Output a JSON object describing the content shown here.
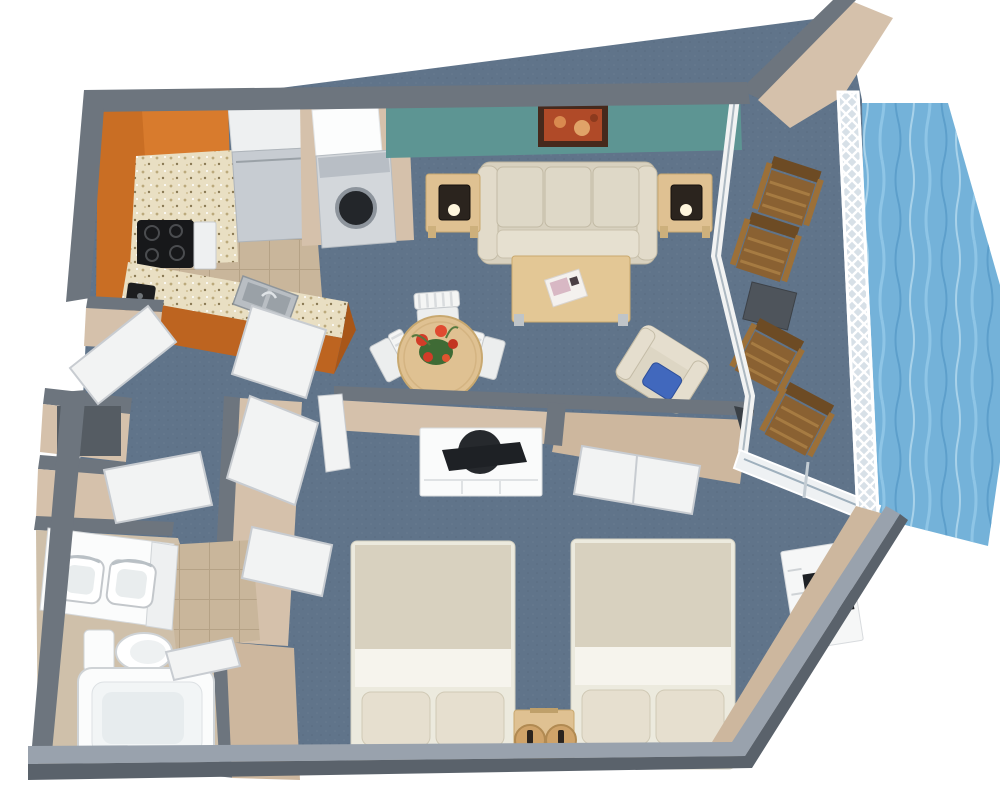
{
  "scene": {
    "type": "3d-floor-plan-rendering",
    "description": "Top-down 3D floor plan of a one-bedroom waterfront suite with kitchen, living-dining room, two-bed bedroom, bathroom and furnished balcony overlooking water"
  },
  "colors": {
    "background": "#ffffff",
    "wall_gray": "#6d757e",
    "wall_gray_dark": "#5a626b",
    "wall_top_light": "#99a2ad",
    "wall_tan": "#d5c1ab",
    "wall_tan_dark": "#c2ab92",
    "accent_teal": "#5d9593",
    "carpet": "#60748a",
    "tile": "#c9b69b",
    "bath_floor": "#cfc0aa",
    "cabinet_orange": "#d87b2d",
    "cabinet_orange_dark": "#bd6420",
    "counter_granite": "#e9dfc3",
    "wood_light": "#dfc192",
    "wood_brown": "#8a6132",
    "fabric_beige": "#d8d1bf",
    "linen_white": "#f6f4ed",
    "furniture_white": "#f3f4f4",
    "appliance_gray": "#c7ccd2",
    "water": "#74b2d9",
    "tv_black": "#1e2125",
    "lamp_black": "#2b241e",
    "pillow_blue": "#4168bd",
    "art_rust": "#b04a28",
    "frame_brown": "#46291c",
    "flower_red": "#d23c28",
    "leaf_green": "#3f6b35",
    "magazine_pink": "#d8b8c4",
    "door_white": "#f2f3f3",
    "niche_dark": "#555c63"
  },
  "rooms": [
    {
      "name": "Kitchen",
      "furniture": [
        "L-shaped orange cabinets",
        "granite countertop peninsula",
        "black cooktop stove",
        "refrigerator",
        "stacked washer-dryer",
        "double-basin sink",
        "coffee maker"
      ]
    },
    {
      "name": "Living Room",
      "furniture": [
        "teal accent wall",
        "framed wall art",
        "three-seat beige sofa",
        "left end table with lamp",
        "right end table with lamp",
        "wood coffee table",
        "magazine"
      ]
    },
    {
      "name": "Dining Area",
      "furniture": [
        "round wood dining table",
        "three white slat chairs",
        "red flower centerpiece",
        "beige armchair with blue pillow"
      ]
    },
    {
      "name": "Bedroom",
      "furniture": [
        "two double beds",
        "wood nightstand with two lamps",
        "media wall with white TV cabinet and television",
        "sliding-door closet",
        "white dresser with television"
      ]
    },
    {
      "name": "Bathroom",
      "furniture": [
        "double sink vanity",
        "toilet",
        "bathtub"
      ]
    },
    {
      "name": "Balcony",
      "furniture": [
        "four wooden lounge chairs",
        "dark side table",
        "white lattice railing",
        "two sliding glass doors"
      ]
    },
    {
      "name": "Exterior",
      "features": [
        "waterfront along right side"
      ]
    }
  ]
}
